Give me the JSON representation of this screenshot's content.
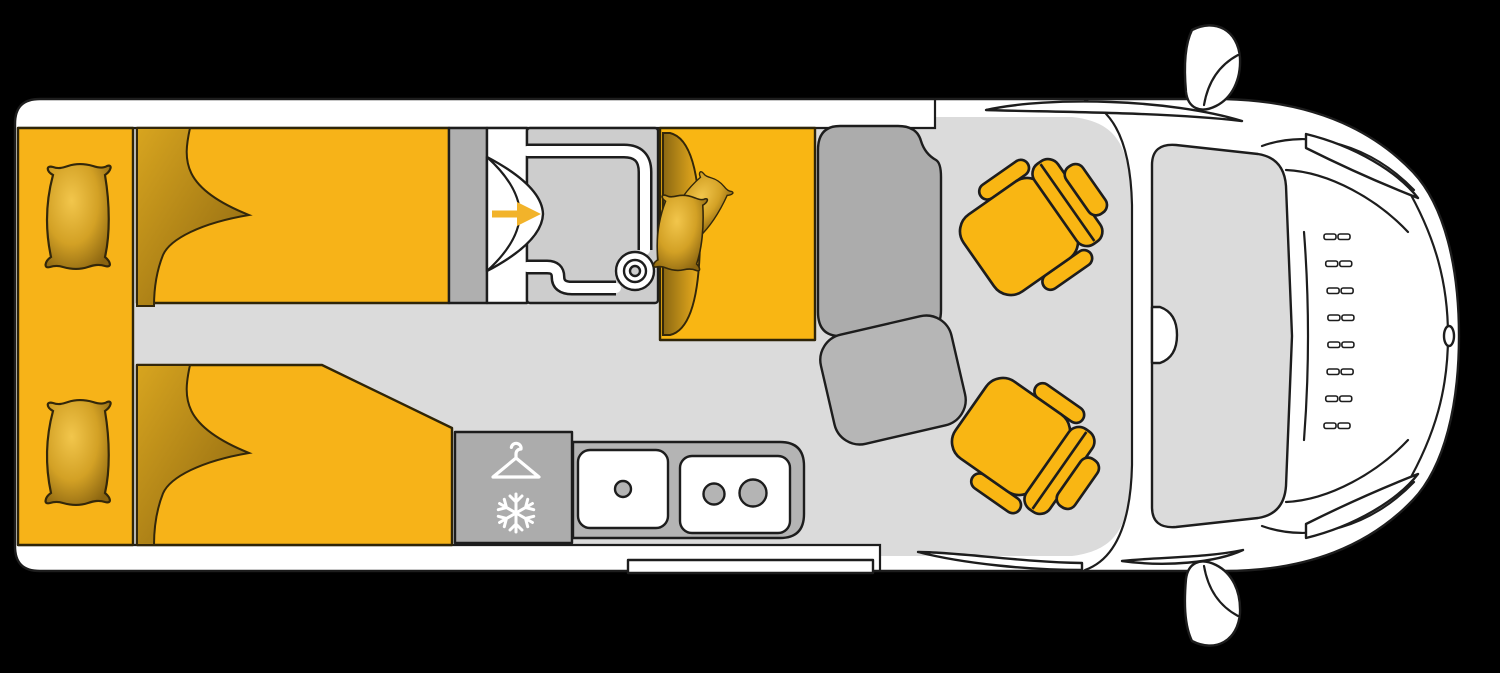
{
  "meta": {
    "kind": "motorhome-floorplan-top-view",
    "canvas": {
      "width": 1500,
      "height": 673
    }
  },
  "colors": {
    "background": "#000000",
    "body_white": "#ffffff",
    "outline": "#1d1d1d",
    "floor": "#dbdbdb",
    "furniture_gray": "#afafaf",
    "table_gray": "#acacac",
    "pad_gray": "#b6b6b6",
    "counter_gray": "#b4b4b4",
    "fridge_gray": "#acacac",
    "tray_gray": "#cdcdcd",
    "windshield_gray": "#dbdbdb",
    "bed_yellow": "#f7b318",
    "seat_yellow": "#f9b613",
    "arrow_yellow": "#f2b32a",
    "icon_white": "#ffffff"
  },
  "zones": {
    "bedroom": {
      "beds": 2,
      "bed_pillows": 2,
      "wardrobe_strips": 1
    },
    "bathroom": {
      "folding_door_arrow_direction": "right",
      "drain_rings": 3
    },
    "dinette": {
      "bench_seats": 1,
      "bench_pillows": 2,
      "tables": 2
    },
    "kitchen": {
      "sink_drains": 1,
      "stove_burners": 2,
      "icons": [
        "hanger-icon",
        "snowflake-icon"
      ],
      "snowflake_arms": 6
    },
    "cab": {
      "swivel_seats": 2,
      "mirrors": 2,
      "headlights": 2,
      "grille": {
        "rows": 8,
        "cols": 2
      }
    }
  }
}
